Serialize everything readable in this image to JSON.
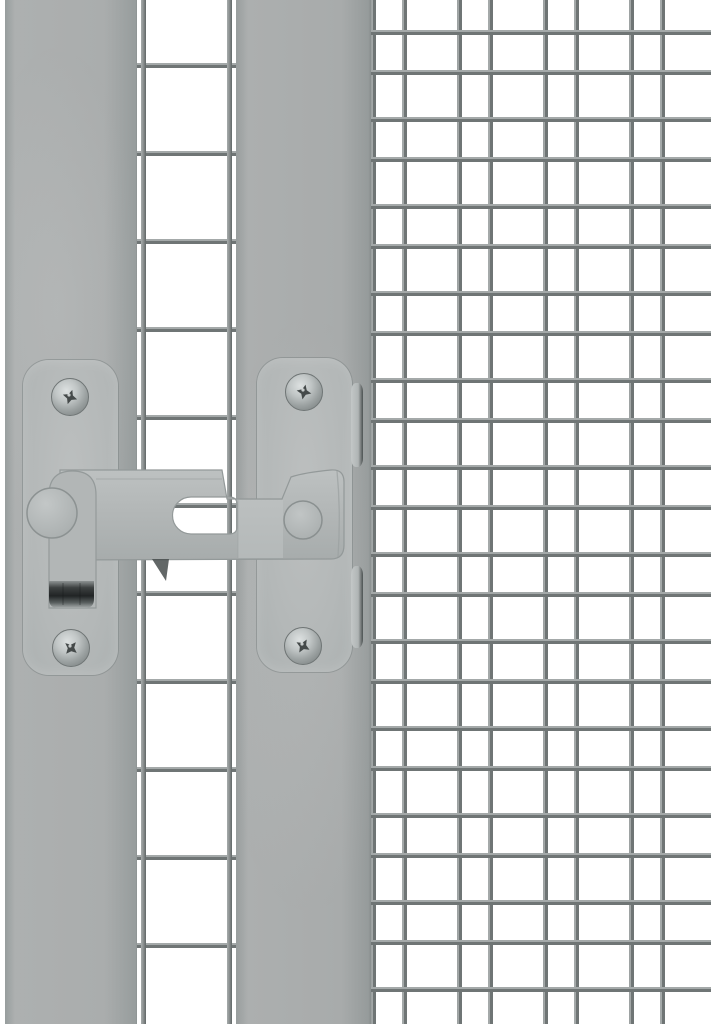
{
  "image": {
    "description": "Close-up product photo of a grey metal gravity flip latch mounted on an aviary door: a grey frame post with large welded mesh on the left and a fine wire mesh panel on the right",
    "background_color": "#ffffff"
  },
  "colors": {
    "post_grey": "#adb0b0",
    "post_edge_dark": "#8f9494",
    "plate_grey": "#b6b9b9",
    "plate_outline": "#9aa0a0",
    "latch_bar": "#b3b7b7",
    "latch_bar_highlight": "#c0c4c4",
    "seam_line": "#9aa0a0",
    "wire_light": "#a4a9a9",
    "wire_dark": "#6f7575",
    "screw_light": "#dde1e1",
    "screw_dark": "#757b7b",
    "screw_recess": "#454a4a",
    "strap_tip_dark": "#212425",
    "shadow_dark": "#474c4c"
  },
  "structure": {
    "left_edge_gap_px": 5,
    "left_post": {
      "x": 5,
      "width": 132
    },
    "door_mesh_opening": {
      "x": 137,
      "width": 99,
      "row_spacing_px": 88,
      "first_row_y": 63,
      "vertical_wires_x": [
        141,
        227
      ]
    },
    "right_post": {
      "x": 236,
      "width": 135
    },
    "fine_mesh_panel": {
      "x": 371,
      "width": 340,
      "column_period_px": 86,
      "row_period_px": 87,
      "wires_per_period": 2
    }
  },
  "latch": {
    "type": "gravity flip latch, grey powder-coated steel",
    "left_plate": {
      "x": 23,
      "y": 360,
      "width": 95,
      "height": 315
    },
    "right_plate": {
      "x": 257,
      "y": 358,
      "width": 95,
      "height": 314
    },
    "screw_centers": [
      [
        70,
        397
      ],
      [
        71,
        648
      ],
      [
        304,
        392
      ],
      [
        303,
        646
      ]
    ],
    "screw_radius": 18,
    "bar": {
      "x1": 60,
      "x2": 344,
      "y_top": 470,
      "y_bottom": 560,
      "slot": {
        "x1": 172,
        "x2": 237,
        "y1": 497,
        "y2": 534
      }
    },
    "knob_center": [
      303,
      520
    ],
    "knob_radius": 19,
    "pivot_center": [
      52,
      513
    ],
    "pivot_radius": 25,
    "strap": {
      "x1": 49,
      "x2": 96,
      "y_top": 471,
      "y_bottom": 608,
      "steel_tip_y": 581
    },
    "keeper_clips": [
      {
        "y": 383,
        "height": 84
      },
      {
        "y": 566,
        "height": 82
      }
    ]
  }
}
